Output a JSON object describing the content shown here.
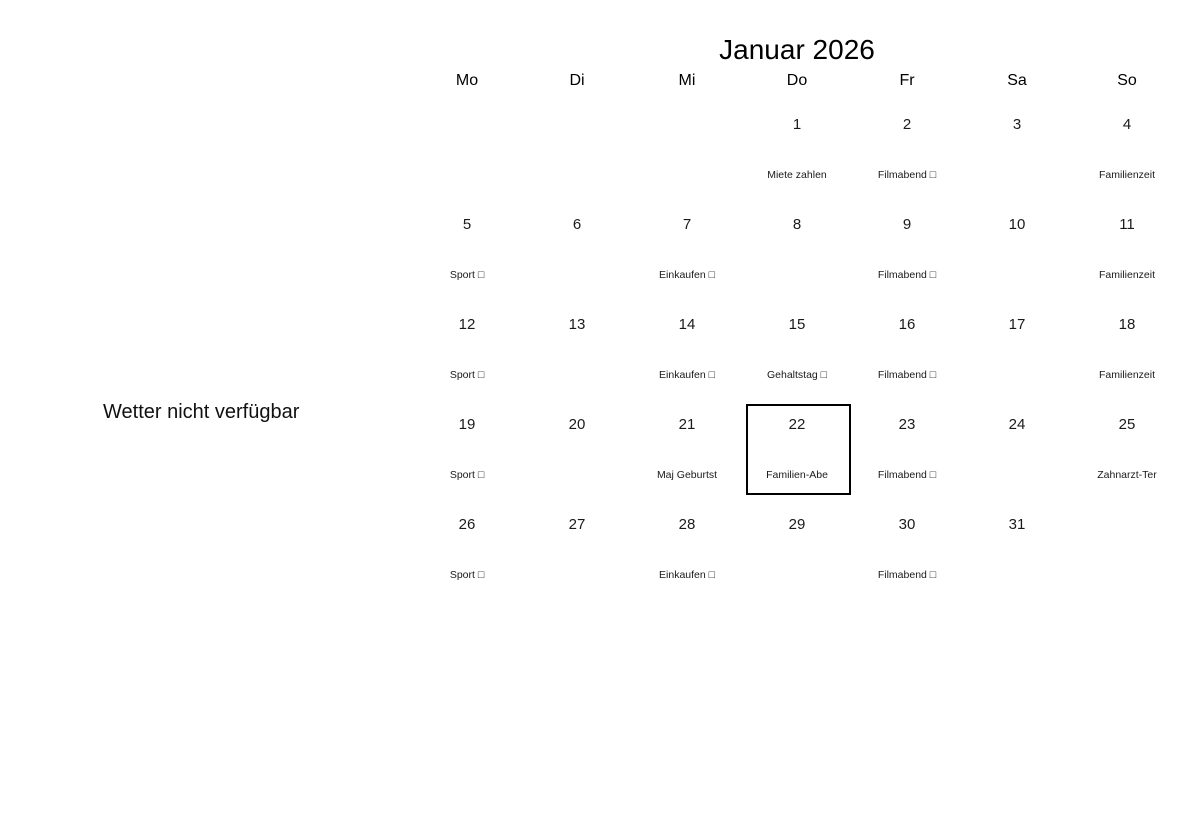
{
  "page": {
    "background_color": "#ffffff",
    "outline_color": "#000000"
  },
  "weather": {
    "notice": "Wetter nicht verfügbar"
  },
  "calendar": {
    "title": "Januar 2026",
    "selected_day": "22",
    "headers": [
      "Mo",
      "Di",
      "Mi",
      "Do",
      "Fr",
      "Sa",
      "So"
    ],
    "weeks": [
      [
        {
          "day": "",
          "event": ""
        },
        {
          "day": "",
          "event": ""
        },
        {
          "day": "",
          "event": ""
        },
        {
          "day": "1",
          "event": "Miete zahlen"
        },
        {
          "day": "2",
          "event": "Filmabend □"
        },
        {
          "day": "3",
          "event": ""
        },
        {
          "day": "4",
          "event": "Familienzeit"
        }
      ],
      [
        {
          "day": "5",
          "event": "Sport □"
        },
        {
          "day": "6",
          "event": ""
        },
        {
          "day": "7",
          "event": "Einkaufen □"
        },
        {
          "day": "8",
          "event": ""
        },
        {
          "day": "9",
          "event": "Filmabend □"
        },
        {
          "day": "10",
          "event": ""
        },
        {
          "day": "11",
          "event": "Familienzeit"
        }
      ],
      [
        {
          "day": "12",
          "event": "Sport □"
        },
        {
          "day": "13",
          "event": ""
        },
        {
          "day": "14",
          "event": "Einkaufen □"
        },
        {
          "day": "15",
          "event": "Gehaltstag □"
        },
        {
          "day": "16",
          "event": "Filmabend □"
        },
        {
          "day": "17",
          "event": ""
        },
        {
          "day": "18",
          "event": "Familienzeit"
        }
      ],
      [
        {
          "day": "19",
          "event": "Sport □"
        },
        {
          "day": "20",
          "event": ""
        },
        {
          "day": "21",
          "event": "Maj Geburtst"
        },
        {
          "day": "22",
          "event": "Familien-Abe"
        },
        {
          "day": "23",
          "event": "Filmabend □"
        },
        {
          "day": "24",
          "event": ""
        },
        {
          "day": "25",
          "event": "Zahnarzt-Ter"
        }
      ],
      [
        {
          "day": "26",
          "event": "Sport □"
        },
        {
          "day": "27",
          "event": ""
        },
        {
          "day": "28",
          "event": "Einkaufen □"
        },
        {
          "day": "29",
          "event": ""
        },
        {
          "day": "30",
          "event": "Filmabend □"
        },
        {
          "day": "31",
          "event": ""
        },
        {
          "day": "",
          "event": ""
        }
      ]
    ]
  }
}
